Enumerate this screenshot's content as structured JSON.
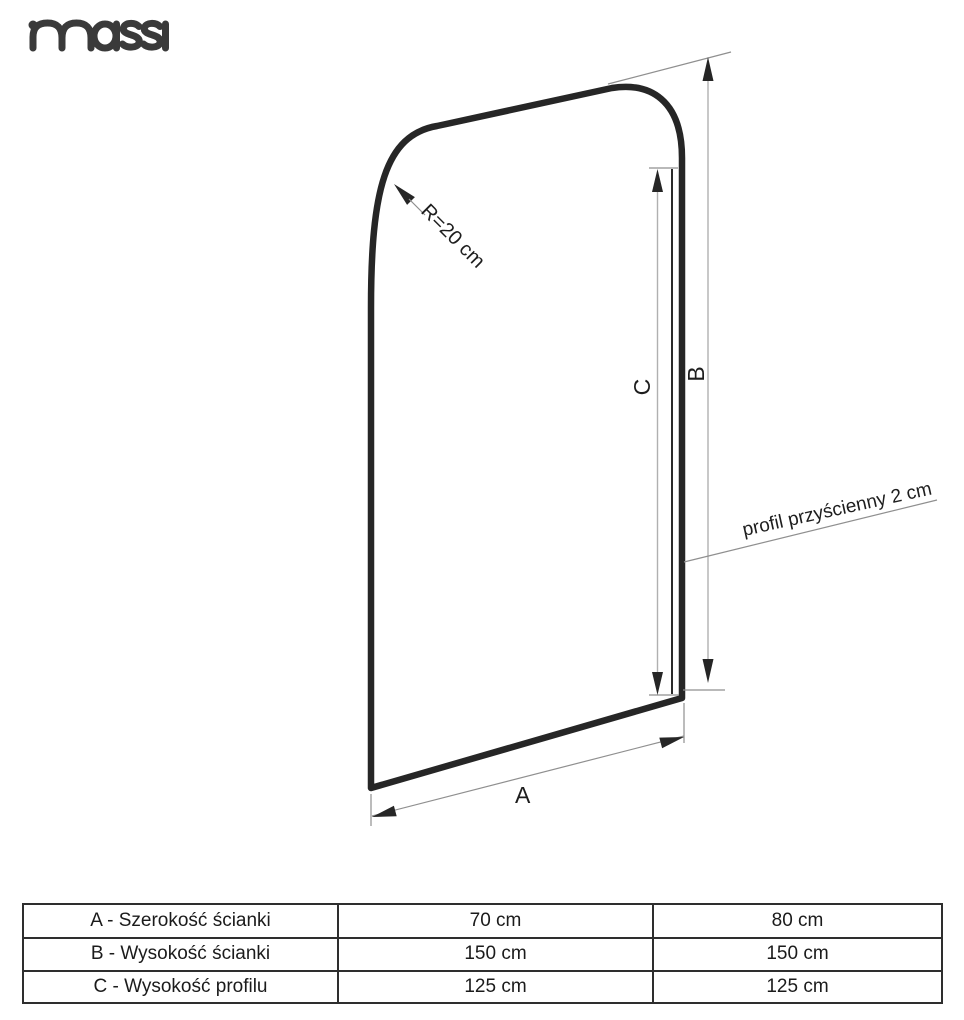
{
  "brand": {
    "logo_text": "massi"
  },
  "diagram": {
    "radius_label": "R=20 cm",
    "dim_width_label": "A",
    "dim_height_label": "B",
    "dim_profile_label": "C",
    "wall_profile_label": "profil przyścienny 2 cm"
  },
  "spec_table": {
    "rows": [
      {
        "label": "A - Szerokość ścianki",
        "values": [
          "70 cm",
          "80 cm"
        ]
      },
      {
        "label": "B - Wysokość ścianki",
        "values": [
          "150 cm",
          "150 cm"
        ]
      },
      {
        "label": "C - Wysokość profilu",
        "values": [
          "125 cm",
          "125 cm"
        ]
      }
    ]
  },
  "colors": {
    "ink": "#262626",
    "extension_gray": "#8f8f8f",
    "dimension_gray": "#b0b0b0",
    "logo_gray": "#3a3a3a"
  }
}
